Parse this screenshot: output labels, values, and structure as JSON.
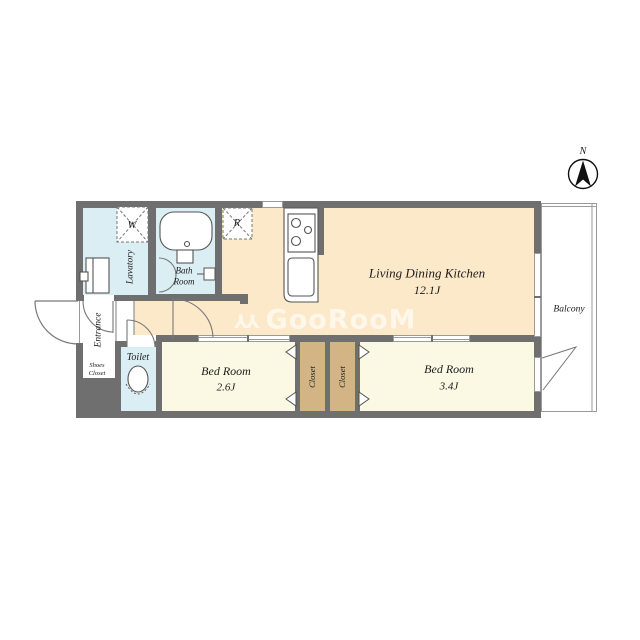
{
  "compass": {
    "label": "N"
  },
  "watermark": {
    "icon_char": "YY",
    "text": "GooRooM"
  },
  "rooms": {
    "ldk": {
      "name": "Living Dining Kitchen",
      "size": "12.1J"
    },
    "bedroom_small": {
      "name": "Bed Room",
      "size": "2.6J"
    },
    "bedroom_large": {
      "name": "Bed Room",
      "size": "3.4J"
    },
    "bath": {
      "line1": "Bath",
      "line2": "Room"
    },
    "lavatory": {
      "name": "Lavatory"
    },
    "toilet": {
      "name": "Toilet"
    },
    "entrance": {
      "name": "Entrance"
    },
    "shoes_closet": {
      "line1": "Shoes",
      "line2": "Closet"
    },
    "closet_left": {
      "name": "Closet"
    },
    "closet_right": {
      "name": "Closet"
    },
    "balcony": {
      "name": "Balcony"
    }
  },
  "appliances": {
    "washer": "W",
    "refrigerator": "R"
  },
  "colors": {
    "wall": "#6f6f6f",
    "water_rooms": "#daeef4",
    "ldk_floor": "#fce9c9",
    "bedroom_floor": "#fbf8e4",
    "closet_floor": "#d3b585",
    "thin_line": "#9a9a9a"
  }
}
